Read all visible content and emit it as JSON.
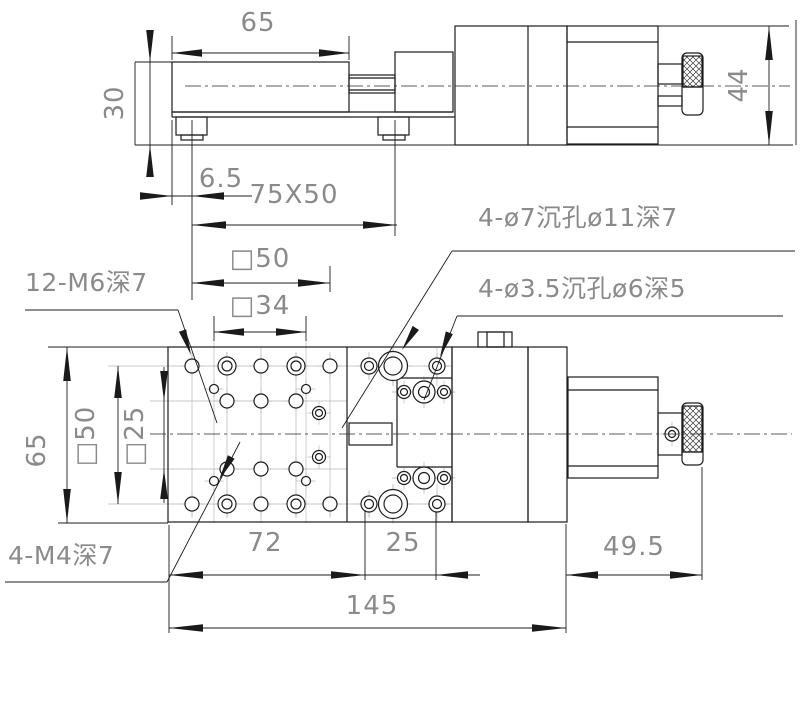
{
  "colors": {
    "background": "#ffffff",
    "line": "#1c1c1c",
    "dimension_text": "#8a8a8a",
    "arrow_fill": "#1a1a1a",
    "centerline": "#b8b8b8"
  },
  "elevation": {
    "width_65": "65",
    "height_30": "30",
    "height_44": "44",
    "offset_6_5": "6.5",
    "plate_75x50": "75X50"
  },
  "plan": {
    "sq50_top": "□50",
    "sq34": "□34",
    "m6_note": "12-M6深7",
    "cbore7_note": "4-ø7沉孔ø11深7",
    "cbore35_note": "4-ø3.5沉孔ø6深5",
    "height_65": "65",
    "sq50_left": "□50",
    "sq25_left": "□25",
    "m4_note": "4-M4深7",
    "w72": "72",
    "w25": "25",
    "w49_5": "49.5",
    "w145": "145"
  }
}
